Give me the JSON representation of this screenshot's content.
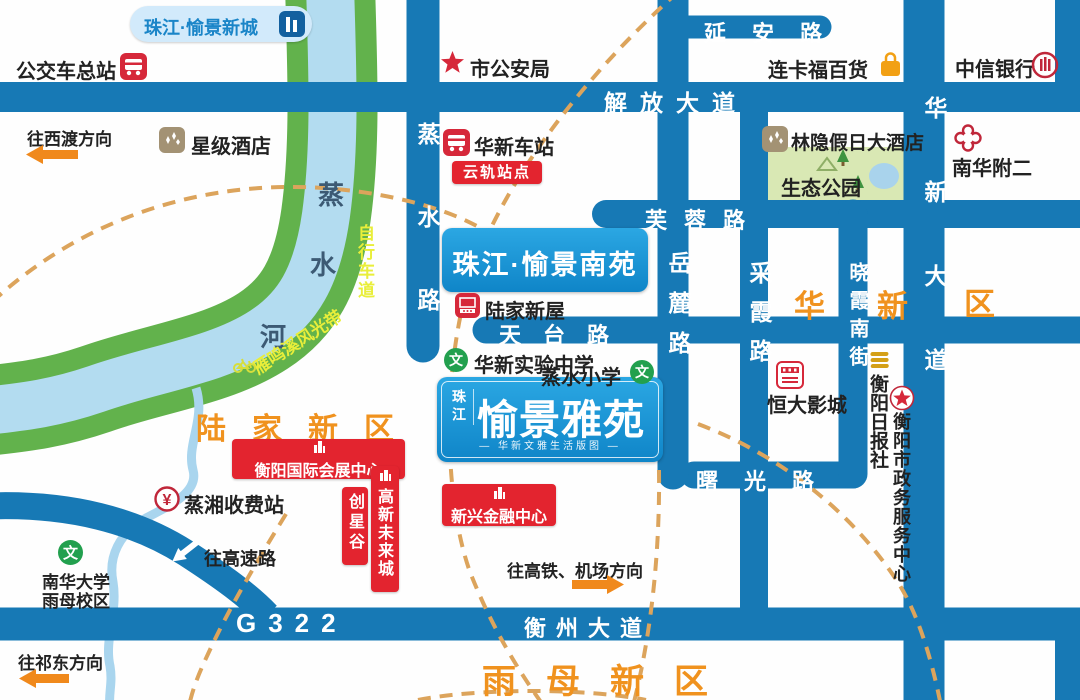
{
  "colors": {
    "road": "#1779b5",
    "river_bank": "#62b24c",
    "river_water": "#b3dcf0",
    "district_orange": "#f0921e",
    "ring_dash": "#dca45c",
    "badge_red": "#e3242f",
    "brand_blue": "#18a0dc"
  },
  "districts": {
    "lujia": "陆家新区",
    "yumu": "雨母新区",
    "huaxin": [
      "华",
      "新",
      "区"
    ]
  },
  "roads": {
    "jiefang": "解放大道",
    "yanan": "延安路",
    "furong": "芙蓉路",
    "tiantai": "天台路",
    "shuguang": "曙光路",
    "hengzhou": "衡州大道",
    "g322": "G322",
    "zhengshui": "蒸水路",
    "yuelu": "岳麓路",
    "caixia": "采霞路",
    "xiaoxia": "晓霞南街",
    "huaxin_ave": "华新大道"
  },
  "river": {
    "chars": [
      "蒸",
      "水",
      "河"
    ],
    "bike_path_a": "雁鸣溪风光带",
    "bike_path_b": "自行车道"
  },
  "projects": {
    "xincheng": "珠江·愉景新城",
    "nanyuan": "珠江·愉景南苑",
    "yayuan_brand": "珠江",
    "yayuan_name": "愉景雅苑",
    "yayuan_tagline": "— 华新文雅生活版图 —"
  },
  "transit": {
    "bus_terminal": "公交车总站",
    "huaxin_station": "华新车站",
    "yungui_badge": "云轨站点",
    "toll": "蒸湘收费站",
    "toll_icon_char": "¥"
  },
  "pois": {
    "police": "市公安局",
    "hotel": "星级酒店",
    "department_store": "连卡福百货",
    "citic_bank": "中信银行",
    "linyin_hotel": "林隐假日大酒店",
    "eco_park": "生态公园",
    "nanhua_hospital": "南华附二",
    "lujia_xinwu": "陆家新屋",
    "huaxin_school": "华新实验中学",
    "zhengshui_school": "蒸水小学",
    "school_icon_char": "文",
    "cinema": "恒大影城",
    "daily_press": "衡阳日报社",
    "gov_center": "衡阳市政务服务中心",
    "expo_center": "衡阳国际会展中心",
    "fin_center": "新兴金融中心",
    "chuangxinggu": "创星谷",
    "gaoxin_city": "高新未来城",
    "nanhua_univ_1": "南华大学",
    "nanhua_univ_2": "雨母校区"
  },
  "directions": {
    "xidu": "往西渡方向",
    "qidong": "往祁东方向",
    "gaosu": "往高速路",
    "gaotie": "往高铁、机场方向"
  }
}
